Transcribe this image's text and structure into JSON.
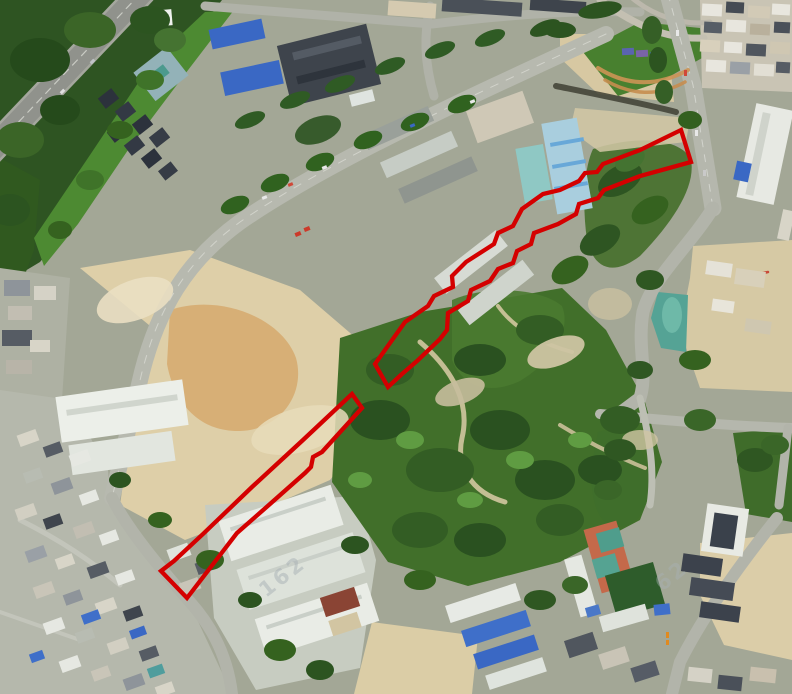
{
  "colors": {
    "annotation_red": "#d40000",
    "watermark_gray": "#a9b1b5"
  },
  "watermarks": [
    {
      "text": "162",
      "x": 266,
      "y": 598,
      "rotation": -38,
      "size": 21,
      "opacity": 0.5
    },
    {
      "text": "62",
      "x": 662,
      "y": 592,
      "rotation": -38,
      "size": 21,
      "opacity": 0.42
    }
  ],
  "annotations": [
    {
      "id": "parcel-boundary-north",
      "points": "681,130 640,150 603,164 597,172 585,173 579,181 560,190 543,194 522,209 513,226 498,233 494,244 466,262 452,276 453,287 434,296 428,306 405,322 375,364 388,387 402,374 417,361 440,339 447,330 448,313 468,301 471,290 490,281 498,269 513,263 517,251 531,244 534,233 558,224 576,214 579,204 598,198 604,190 640,176 691,162",
      "stroke_width": 4.3
    },
    {
      "id": "parcel-boundary-south",
      "points": "352,394 303,440 252,487 203,534 174,561 161,571 187,598 237,533 270,504 305,473 311,467 313,457 322,452 362,408",
      "stroke_width": 4.3
    }
  ]
}
